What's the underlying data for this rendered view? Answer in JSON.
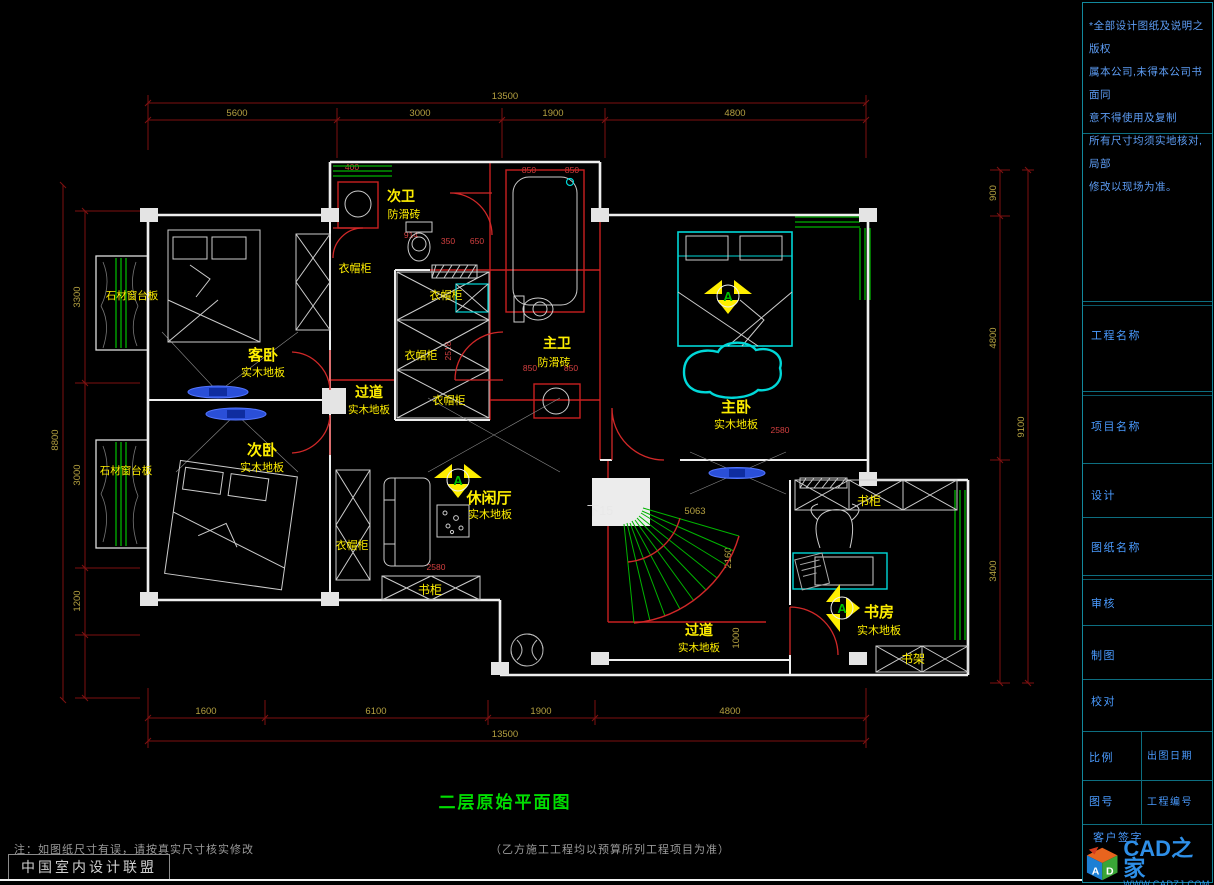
{
  "notes": {
    "lines": [
      "*全部设计图纸及说明之版权",
      "属本公司,未得本公司书面同",
      "意不得使用及复制",
      "所有尺寸均须实地核对,局部",
      "修改以现场为准。"
    ]
  },
  "title_block": {
    "project_label": "工程名称",
    "item_label": "项目名称",
    "design_label": "设计",
    "sheet_name_label": "图纸名称",
    "review_label": "审核",
    "draft_label": "制图",
    "check_label": "校对",
    "scale_label": "比例",
    "date_label": "出图日期",
    "sheet_no_label": "图号",
    "project_no_label": "工程编号",
    "signature_label": "客户签字"
  },
  "logo": {
    "brand": "CAD之家",
    "site": "WWW.CADZJ.COM",
    "cube_a": "A",
    "cube_d": "D"
  },
  "footer": {
    "note_1": "注：如图纸尺寸有误，请按真实尺寸核实修改",
    "note_2": "（乙方施工工程均以预算所列工程项目为准）",
    "org": "中国室内设计联盟"
  },
  "drawing": {
    "title": "二层原始平面图",
    "rooms": [
      {
        "name": "客卧",
        "floor": "实木地板"
      },
      {
        "name": "次卧",
        "floor": "实木地板"
      },
      {
        "name": "次卫",
        "floor": "防滑砖"
      },
      {
        "name": "主卫",
        "floor": "防滑砖"
      },
      {
        "name": "主卧",
        "floor": "实木地板"
      },
      {
        "name": "休闲厅",
        "floor": "实木地板"
      },
      {
        "name": "过道",
        "floor": "实木地板"
      },
      {
        "name": "过道",
        "floor": "实木地板"
      },
      {
        "name": "书房",
        "floor": "实木地板"
      }
    ],
    "fixtures": {
      "wardrobe": "衣帽柜",
      "bookcase": "书柜",
      "bookshelf": "书架",
      "stone_sill": "石材窗台板",
      "stairs_note": "下15"
    },
    "marker_letter": "A",
    "dims": {
      "top_overall": "13500",
      "top": [
        "5600",
        "3000",
        "1900",
        "4800"
      ],
      "bottom_overall": "13500",
      "bottom": [
        "1600",
        "6100",
        "1900",
        "4800"
      ],
      "left_overall": "8800",
      "left": [
        "3300",
        "3000",
        "1200"
      ],
      "right_overall": "9100",
      "right": [
        "900",
        "4800",
        "3400"
      ],
      "interior": [
        "2580",
        "2580",
        "5063",
        "1000",
        "2160",
        "2518",
        "850",
        "850",
        "914",
        "650",
        "350",
        "400",
        "850",
        "850"
      ]
    }
  },
  "colors": {
    "label_yellow": "#ffef00",
    "wall_white": "#eeeeee",
    "window_green": "#00b400",
    "line_red": "#c82020",
    "dim_text": "#b4a040",
    "panel_teal": "#0d6e80",
    "panel_text_blue": "#4a9bff",
    "title_green": "#00dd00",
    "logo_blue": "#2e8fe8"
  }
}
